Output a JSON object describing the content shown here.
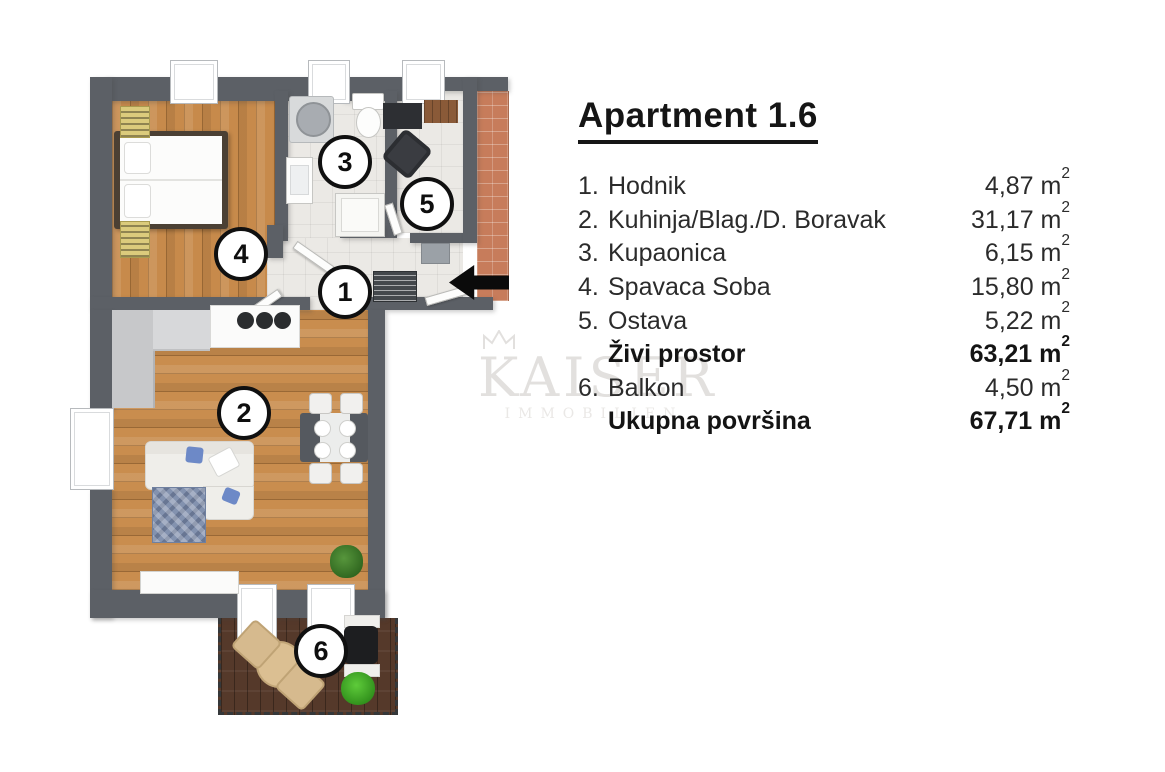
{
  "legend": {
    "title": "Apartment 1.6",
    "unit_base": "m",
    "unit_exp": "2",
    "rooms": [
      {
        "num": "1.",
        "name": "Hodnik",
        "area": "4,87",
        "bold": false
      },
      {
        "num": "2.",
        "name": "Kuhinja/Blag./D. Boravak",
        "area": "31,17",
        "bold": false
      },
      {
        "num": "3.",
        "name": "Kupaonica",
        "area": "6,15",
        "bold": false
      },
      {
        "num": "4.",
        "name": "Spavaca Soba",
        "area": "15,80",
        "bold": false
      },
      {
        "num": "5.",
        "name": "Ostava",
        "area": "5,22",
        "bold": false
      },
      {
        "num": "",
        "name": "Živi prostor",
        "area": "63,21",
        "bold": true
      },
      {
        "num": "6.",
        "name": "Balkon",
        "area": "4,50",
        "bold": false
      },
      {
        "num": "",
        "name": "Ukupna površina",
        "area": "67,71",
        "bold": true
      }
    ]
  },
  "watermark": {
    "line1": "KAISER",
    "line2": "IMMOBILIEN"
  },
  "plan": {
    "markers": {
      "hallway": "1",
      "living": "2",
      "bathroom": "3",
      "bedroom": "4",
      "storage": "5",
      "balcony": "6"
    },
    "colors": {
      "wall": "#5c6066",
      "wood_floor": "#c78a4b",
      "tile_floor": "#ebe9e5",
      "brick": "#c77c5b",
      "balcony_deck": "#55392a",
      "rug_blue": "#8392af",
      "pillow_blue": "#6d89c7",
      "radiator_yellow": "#dbcb7c",
      "text": "#1f1f1f",
      "watermark_gray": "#e2e0de"
    }
  }
}
